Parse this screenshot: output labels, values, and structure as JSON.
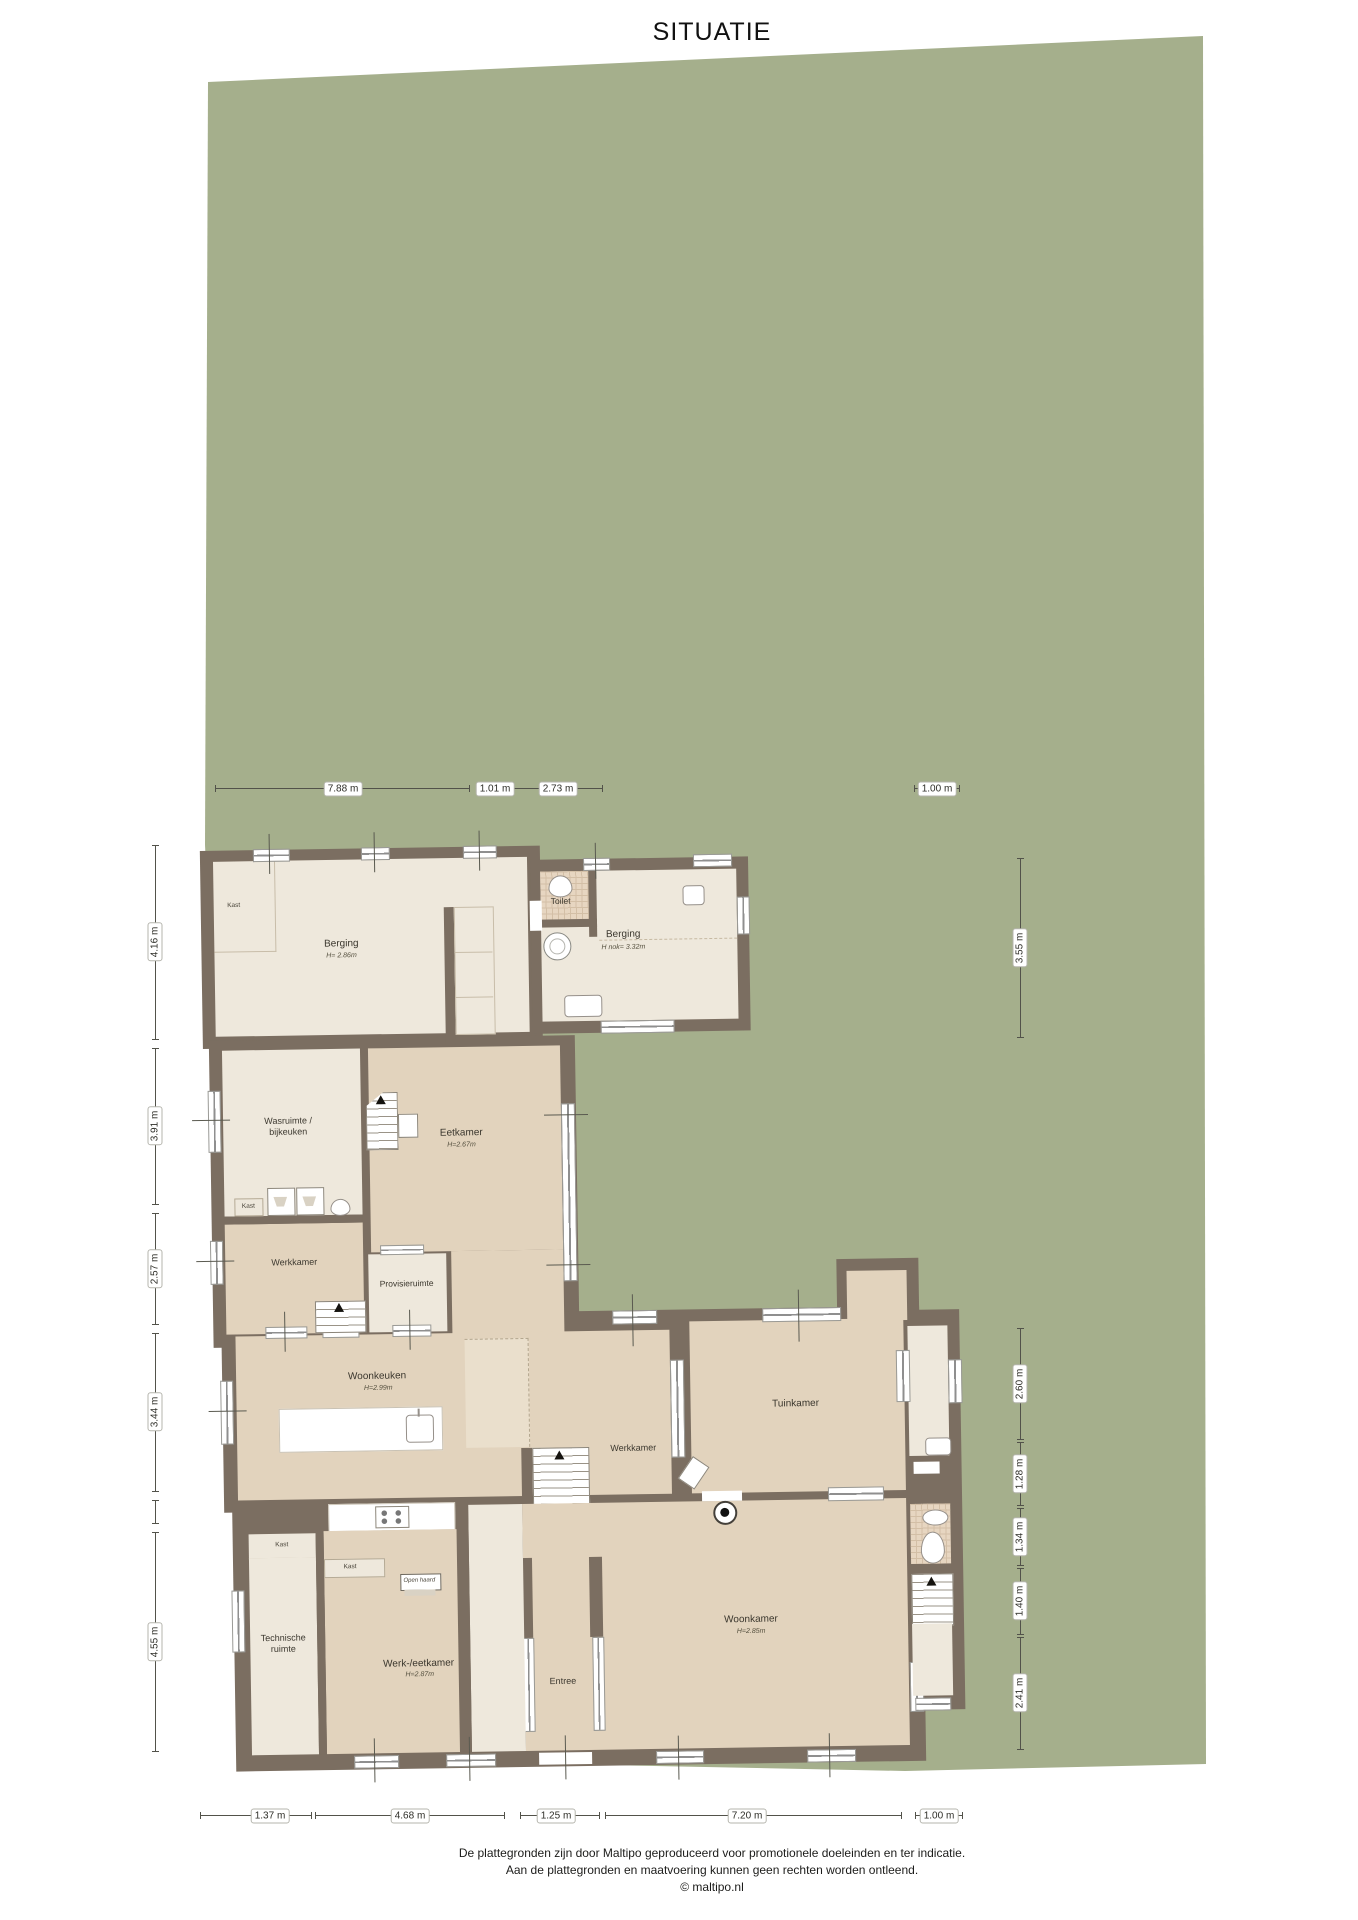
{
  "title": "SITUATIE",
  "colors": {
    "plot_green": "#a5af8c",
    "wall_brown": "#7b6e61",
    "floor_light": "#eee8dc",
    "floor_dark": "#e2d3bd",
    "tile": "#e7d6c1"
  },
  "rooms": {
    "kast_berging": {
      "label": "Kast"
    },
    "berging1": {
      "label": "Berging",
      "height": "H= 2.86m"
    },
    "toilet1": {
      "label": "Toilet"
    },
    "berging2": {
      "label": "Berging",
      "height": "H nok= 3.32m"
    },
    "wasruimte": {
      "label": "Wasruimte /",
      "label2": "bijkeuken"
    },
    "eetkamer": {
      "label": "Eetkamer",
      "height": "H=2.67m"
    },
    "kast_wasruimte": {
      "label": "Kast"
    },
    "werkkamer_links": {
      "label": "Werkkamer"
    },
    "provisieruimte": {
      "label": "Provisieruimte"
    },
    "woonkeuken": {
      "label": "Woonkeuken",
      "height": "H=2.99m"
    },
    "werkkamer_midden": {
      "label": "Werkkamer"
    },
    "tuinkamer": {
      "label": "Tuinkamer"
    },
    "kast_technische": {
      "label": "Kast"
    },
    "kast_werkeetkamer": {
      "label": "Kast"
    },
    "open_haard": {
      "label": "Open haard"
    },
    "technische": {
      "label": "Technische",
      "label2": "ruimte"
    },
    "werkeetkamer": {
      "label": "Werk-/eetkamer",
      "height": "H=2.87m"
    },
    "entree": {
      "label": "Entree"
    },
    "woonkamer": {
      "label": "Woonkamer",
      "height": "H=2.85m"
    }
  },
  "dimensions": {
    "top": [
      "7.88 m",
      "1.01 m",
      "2.73 m",
      "1.00 m"
    ],
    "left": [
      "4.16 m",
      "3.91 m",
      "2.57 m",
      "3.44 m",
      "4.55 m"
    ],
    "right": [
      "3.55 m",
      "2.60 m",
      "1.28 m",
      "1.34 m",
      "1.40 m",
      "2.41 m"
    ],
    "bottom": [
      "1.37 m",
      "4.68 m",
      "1.25 m",
      "7.20 m",
      "1.00 m"
    ]
  },
  "footer": {
    "line1": "De plattegronden zijn door Maltipo geproduceerd voor promotionele doeleinden en ter indicatie.",
    "line2": "Aan de plattegronden en maatvoering kunnen geen rechten worden ontleend.",
    "line3": "© maltipo.nl"
  }
}
